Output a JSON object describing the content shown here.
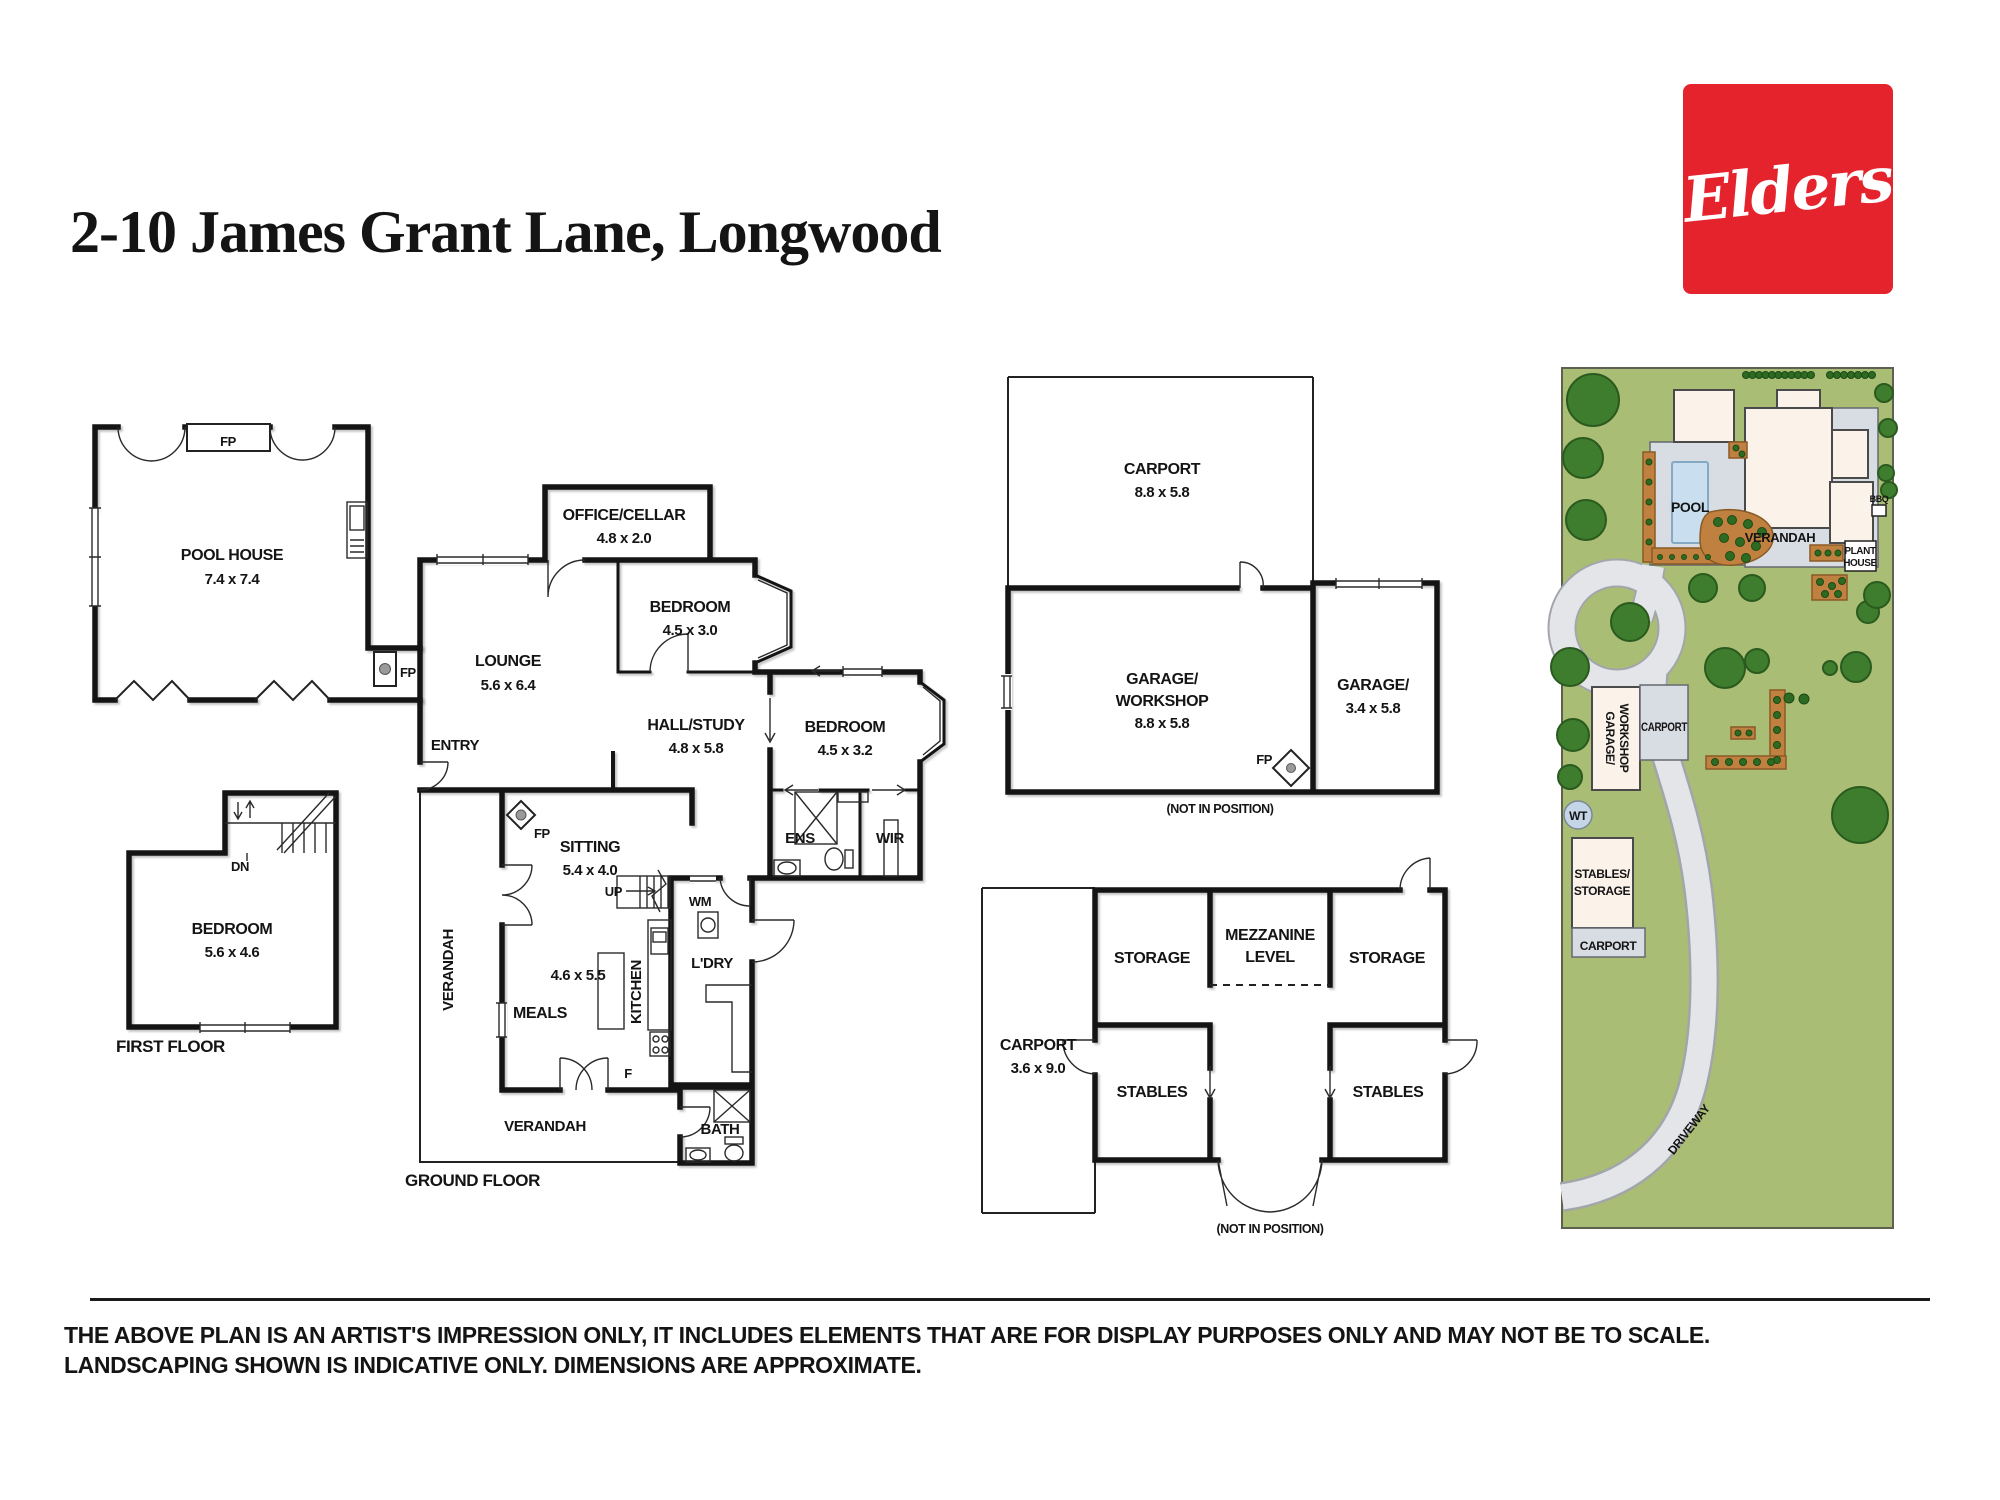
{
  "title": "2-10 James Grant Lane, Longwood",
  "logo": {
    "text": "Elders",
    "bg_color": "#E4232C",
    "text_color": "#FFFFFF"
  },
  "pool_house": {
    "name": "POOL HOUSE",
    "dims": "7.4 x 7.4",
    "fp_top": "FP",
    "fp_side": "FP"
  },
  "first_floor": {
    "label": "FIRST FLOOR",
    "room": "BEDROOM",
    "dims": "5.6 x 4.6",
    "dn": "DN"
  },
  "ground": {
    "label": "GROUND FLOOR",
    "entry": "ENTRY",
    "lounge": "LOUNGE",
    "lounge_dims": "5.6 x 6.4",
    "office": "OFFICE/CELLAR",
    "office_dims": "4.8 x 2.0",
    "bed1": "BEDROOM",
    "bed1_dims": "4.5 x 3.0",
    "hall": "HALL/STUDY",
    "hall_dims": "4.8 x 5.8",
    "bed2": "BEDROOM",
    "bed2_dims": "4.5 x 3.2",
    "ens": "ENS",
    "wir": "WIR",
    "sitting": "SITTING",
    "sitting_dims": "5.4 x 4.0",
    "fp": "FP",
    "up": "UP",
    "wm": "WM",
    "f": "F",
    "kitchen": "KITCHEN",
    "kitchen_dims": "4.6 x 5.5",
    "meals": "MEALS",
    "ldry": "L'DRY",
    "bath": "BATH",
    "verandah_side": "VERANDAH",
    "verandah_bottom": "VERANDAH"
  },
  "garage_block": {
    "carport": "CARPORT",
    "carport_dims": "8.8 x 5.8",
    "garage1_line1": "GARAGE/",
    "garage1_line2": "WORKSHOP",
    "garage1_dims": "8.8 x 5.8",
    "garage2_line1": "GARAGE/",
    "garage2_dims": "3.4 x 5.8",
    "fp": "FP",
    "note": "(NOT IN POSITION)"
  },
  "stables_block": {
    "carport": "CARPORT",
    "carport_dims": "3.6 x 9.0",
    "storage_left": "STORAGE",
    "storage_right": "STORAGE",
    "mezzanine_line1": "MEZZANINE",
    "mezzanine_line2": "LEVEL",
    "stables_left": "STABLES",
    "stables_right": "STABLES",
    "note": "(NOT IN POSITION)"
  },
  "site": {
    "pool": "POOL",
    "verandah": "VERANDAH",
    "plant_house_line1": "PLANT",
    "plant_house_line2": "HOUSE",
    "bbq": "BBQ",
    "garage_workshop_line1": "GARAGE/",
    "garage_workshop_line2": "WORKSHOP",
    "carport_upper": "CARPORT",
    "wt": "WT",
    "stables_storage_line1": "STABLES/",
    "stables_storage_line2": "STORAGE",
    "carport_lower": "CARPORT",
    "driveway": "DRIVEWAY",
    "colors": {
      "grass": "#A9BD74",
      "tree": "#3E7D2E",
      "driveway": "#E3E5E8",
      "paving": "#D8DDE3",
      "building": "#FBF2EA",
      "pool_water": "#C9DFF0",
      "garden_bed": "#C08040",
      "water_tank": "#C3D5E6"
    }
  },
  "disclaimer": {
    "line1": "THE ABOVE PLAN IS AN ARTIST'S IMPRESSION ONLY, IT INCLUDES ELEMENTS THAT ARE FOR DISPLAY PURPOSES ONLY AND MAY NOT BE TO SCALE.",
    "line2": "LANDSCAPING SHOWN IS INDICATIVE ONLY. DIMENSIONS ARE APPROXIMATE."
  },
  "plan_ink": "#141414"
}
